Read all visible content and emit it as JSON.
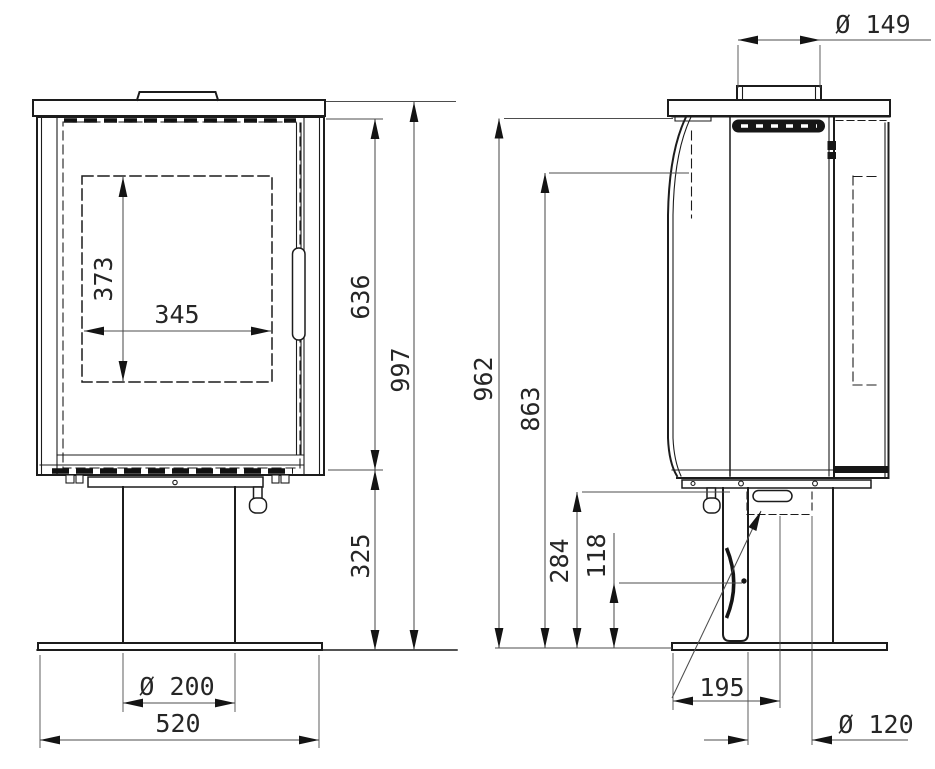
{
  "drawing": {
    "front_view": {
      "glass_height": "373",
      "glass_width": "345",
      "firebox_height": "636",
      "overall_height": "997",
      "pedestal_height": "325",
      "pedestal_diameter": "Ø 200",
      "base_width": "520"
    },
    "side_view": {
      "flue_collar_diameter": "Ø 149",
      "body_top_height": "962",
      "flue_outlet_height": "863",
      "air_intake_height": "284",
      "pivot_height": "118",
      "air_intake_offset": "195",
      "air_intake_diameter": "Ø 120"
    }
  }
}
